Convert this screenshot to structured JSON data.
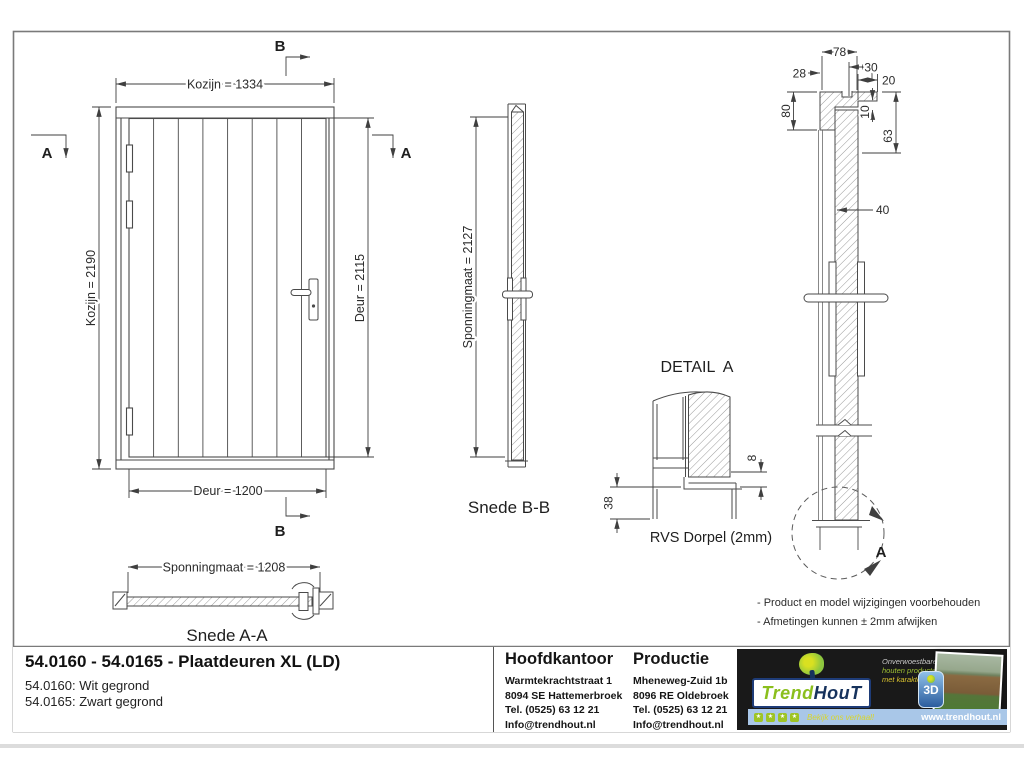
{
  "drawing": {
    "front_view": {
      "dim_top": "Kozijn = 1334",
      "dim_left": "Kozijn = 2190",
      "dim_right": "Deur = 2115",
      "dim_bottom": "Deur = 1200",
      "marker_a": "A",
      "marker_b": "B"
    },
    "snede_aa": {
      "dim": "Sponningmaat = 1208",
      "label": "Snede A-A"
    },
    "snede_bb": {
      "dim": "Sponningmaat = 2127",
      "label": "Snede B-B"
    },
    "detail_a": {
      "title": "DETAIL  A",
      "dim_8": "8",
      "dim_38": "38",
      "label": "RVS Dorpel (2mm)"
    },
    "right_section": {
      "dim_78": "78",
      "dim_28": "28",
      "dim_30": "30",
      "dim_20": "20",
      "dim_80": "80",
      "dim_10": "10",
      "dim_63": "63",
      "dim_40": "40",
      "marker_a": "A"
    },
    "notes": [
      "- Product en model wijzigingen voorbehouden",
      "- Afmetingen kunnen ± 2mm afwijken"
    ]
  },
  "title_block": {
    "title": "54.0160 - 54.0165 - Plaatdeuren XL (LD)",
    "variants": [
      "54.0160: Wit gegrond",
      "54.0165: Zwart gegrond"
    ],
    "hoofdkantoor": {
      "heading": "Hoofdkantoor",
      "lines": [
        "Warmtekrachtstraat 1",
        "8094 SE Hattemerbroek",
        "Tel. (0525) 63 12 21",
        "Info@trendhout.nl"
      ]
    },
    "productie": {
      "heading": "Productie",
      "lines": [
        "Mheneweg-Zuid 1b",
        "8096 RE Oldebroek",
        "Tel. (0525) 63 12 21",
        "Info@trendhout.nl"
      ]
    }
  },
  "branding": {
    "brand_trend": "Trend",
    "brand_hout": "HouT",
    "slogan": [
      "Onverwoestbare",
      "houten producten",
      "met karakter"
    ],
    "badge_3d": "3D",
    "star": "★",
    "tagline": "Bekijk ons verhaal!",
    "website": "www.trendhout.nl",
    "colors": {
      "green": "#8dc63f",
      "navy": "#16325c",
      "yellow": "#d9c22e",
      "bar_blue": "#a9c7e8",
      "dark": "#191919"
    }
  }
}
